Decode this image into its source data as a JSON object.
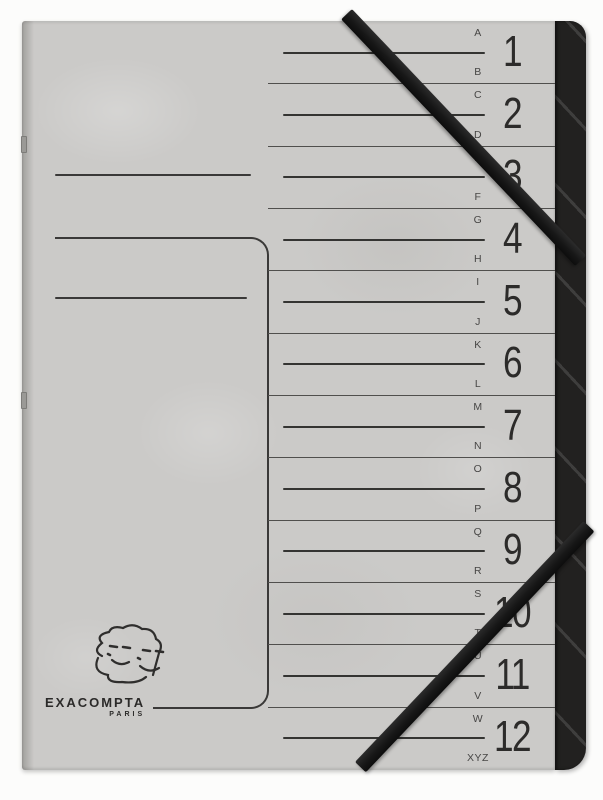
{
  "product": {
    "kind": "multi-part index folder photo",
    "brand": {
      "name": "EXACOMPTA",
      "city": "PARIS"
    }
  },
  "index": {
    "sections": [
      {
        "number": "1",
        "letter_top": "A",
        "letter_bottom": "B"
      },
      {
        "number": "2",
        "letter_top": "C",
        "letter_bottom": "D"
      },
      {
        "number": "3",
        "letter_top": "E",
        "letter_bottom": "F"
      },
      {
        "number": "4",
        "letter_top": "G",
        "letter_bottom": "H"
      },
      {
        "number": "5",
        "letter_top": "I",
        "letter_bottom": "J"
      },
      {
        "number": "6",
        "letter_top": "K",
        "letter_bottom": "L"
      },
      {
        "number": "7",
        "letter_top": "M",
        "letter_bottom": "N"
      },
      {
        "number": "8",
        "letter_top": "O",
        "letter_bottom": "P"
      },
      {
        "number": "9",
        "letter_top": "Q",
        "letter_bottom": "R"
      },
      {
        "number": "10",
        "letter_top": "S",
        "letter_bottom": "T"
      },
      {
        "number": "11",
        "letter_top": "U",
        "letter_bottom": "V"
      },
      {
        "number": "12",
        "letter_top": "W",
        "letter_bottom": "XYZ"
      }
    ]
  },
  "colors": {
    "folder_gray": "#cbcac8",
    "back_cover_black": "#222120",
    "elastic_black": "#1c1c1c",
    "print_line": "#3a3938",
    "background_white": "#fcfcfb"
  }
}
